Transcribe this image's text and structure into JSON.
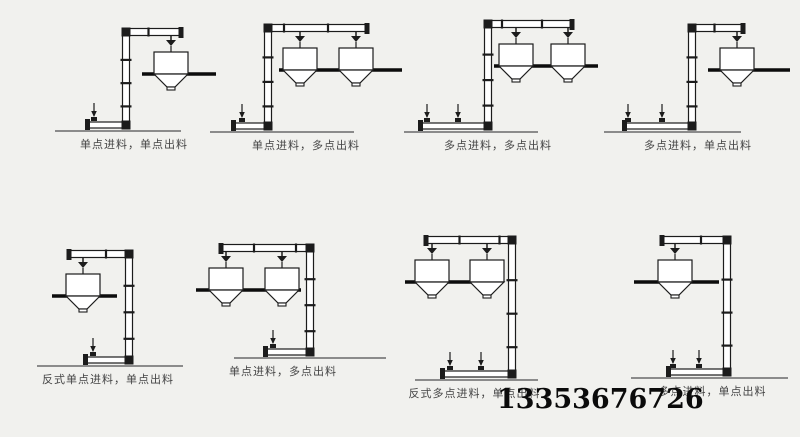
{
  "page": {
    "background": "#f1f1ee"
  },
  "colors": {
    "line": "#1c1c1c",
    "fill": "#ffffff",
    "ground": "#8b8b8b",
    "platform": "#0c0c0c",
    "caption_text": "#454545",
    "phone_text": "#0b0b0b"
  },
  "phone": {
    "number": "13353676726",
    "left": 497,
    "top": 384
  },
  "diagrams": [
    {
      "label": "单点进料，单点出料",
      "arm_dir": "right",
      "cell": {
        "left": 50,
        "top": 20,
        "width": 168,
        "height": 113
      },
      "label_shift": 0,
      "geom": {
        "col": 0.45,
        "arm_end": 0.78,
        "run_start": 0.22,
        "feeds": [
          0.26
        ],
        "hoppers": [
          0.72
        ],
        "platform": [
          0.55,
          0.99
        ],
        "ground": [
          0.03,
          0.78
        ]
      }
    },
    {
      "label": "单点进料，多点出料",
      "arm_dir": "right",
      "cell": {
        "left": 210,
        "top": 16,
        "width": 192,
        "height": 118
      },
      "label_shift": 0,
      "geom": {
        "col": 0.3,
        "arm_end": 0.82,
        "run_start": 0.12,
        "feeds": [
          0.165
        ],
        "hoppers": [
          0.47,
          0.76
        ],
        "platform": [
          0.36,
          1.0
        ],
        "ground": [
          0.0,
          0.75
        ]
      }
    },
    {
      "label": "多点进料，多点出料",
      "arm_dir": "right",
      "cell": {
        "left": 398,
        "top": 12,
        "width": 200,
        "height": 122
      },
      "label_shift": 0,
      "geom": {
        "col": 0.45,
        "arm_end": 0.87,
        "run_start": 0.11,
        "feeds": [
          0.145,
          0.3
        ],
        "hoppers": [
          0.59,
          0.85
        ],
        "platform": [
          0.48,
          1.0
        ],
        "ground": [
          0.03,
          0.7
        ]
      }
    },
    {
      "label": "多点进料，单点出料",
      "arm_dir": "right",
      "cell": {
        "left": 600,
        "top": 16,
        "width": 196,
        "height": 118
      },
      "label_shift": 0,
      "geom": {
        "col": 0.47,
        "arm_end": 0.73,
        "run_start": 0.12,
        "feeds": [
          0.145,
          0.315
        ],
        "hoppers": [
          0.7
        ],
        "platform": [
          0.55,
          0.97
        ],
        "ground": [
          0.02,
          0.72
        ]
      }
    },
    {
      "label": "反式单点进料，单点出料",
      "arm_dir": "left",
      "cell": {
        "left": 28,
        "top": 242,
        "width": 172,
        "height": 126
      },
      "label_shift": -6,
      "geom": {
        "col": 0.59,
        "arm_end": 0.24,
        "run_start": 0.33,
        "feeds": [
          0.375
        ],
        "hoppers": [
          0.32
        ],
        "platform": [
          0.14,
          0.52
        ],
        "ground": [
          0.05,
          0.9
        ]
      }
    },
    {
      "label": "单点进料，多点出料",
      "arm_dir": "left",
      "cell": {
        "left": 196,
        "top": 236,
        "width": 190,
        "height": 124
      },
      "label_shift": -8,
      "geom": {
        "col": 0.6,
        "arm_end": 0.13,
        "run_start": 0.365,
        "feeds": [
          0.405
        ],
        "hoppers": [
          0.16,
          0.45
        ],
        "platform": [
          0.0,
          0.55
        ],
        "ground": [
          0.2,
          1.0
        ]
      }
    },
    {
      "label": "反式多点进料，单点出料",
      "arm_dir": "left",
      "cell": {
        "left": 405,
        "top": 228,
        "width": 195,
        "height": 154
      },
      "label_shift": -28,
      "geom": {
        "col": 0.55,
        "arm_end": 0.11,
        "run_start": 0.19,
        "feeds": [
          0.23,
          0.39
        ],
        "hoppers": [
          0.14,
          0.42
        ],
        "platform": [
          0.0,
          0.5
        ],
        "ground": [
          0.05,
          0.68
        ]
      }
    },
    {
      "label": "多点进料，单点出料",
      "arm_dir": "left",
      "cell": {
        "left": 612,
        "top": 228,
        "width": 185,
        "height": 152
      },
      "label_shift": 8,
      "geom": {
        "col": 0.62,
        "arm_end": 0.27,
        "run_start": 0.3,
        "feeds": [
          0.33,
          0.47
        ],
        "hoppers": [
          0.34
        ],
        "platform": [
          0.12,
          0.58
        ],
        "ground": [
          0.1,
          0.95
        ]
      }
    }
  ]
}
